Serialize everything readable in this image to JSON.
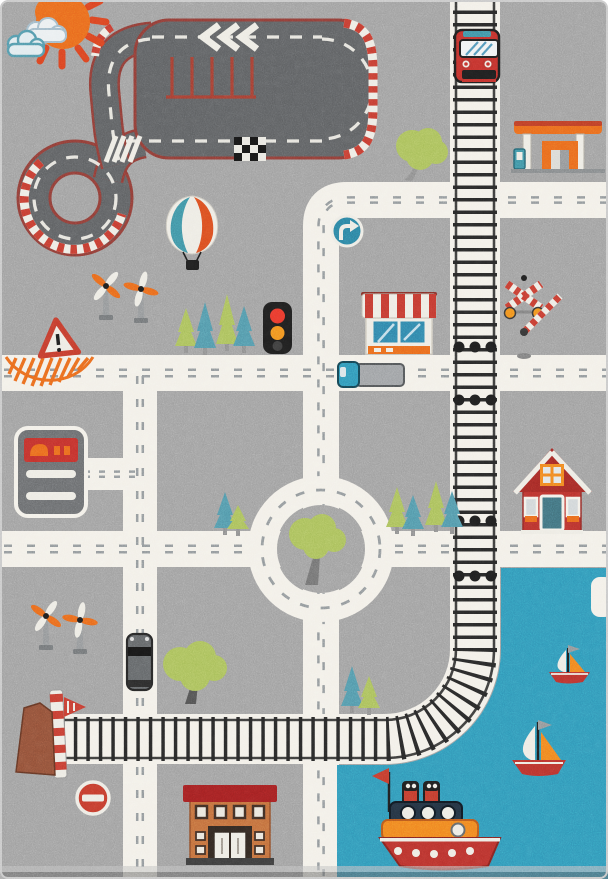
{
  "title": "Children's play rug photo: city road map with race track, railway, roundabout and harbor",
  "colors": {
    "rug_gray": "#9c9c9c",
    "road_white": "#f2efe7",
    "road_dash": "#8d9396",
    "track_asphalt": "#5b5d5f",
    "track_border": "#8a3a34",
    "curb_red": "#c23a2f",
    "water_teal": "#2f93b5",
    "rail_white": "#f2efe7",
    "sleeper_black": "#262626",
    "red": "#bf2f2a",
    "orange": "#e8651c",
    "teal": "#3d8ea0",
    "leaf_green": "#a6bd58",
    "pine_teal": "#4f93a6",
    "navy": "#22303e",
    "off_white": "#eceae2",
    "near_black": "#1d1d1d",
    "brick_orange": "#bf6a3a",
    "roof_red": "#9e1f20",
    "sign_blue": "#2a7d9d",
    "gray_mid": "#8f9294",
    "building_gray": "#67696b"
  },
  "inventory": [
    {
      "name": "sun",
      "desc": "orange sun with red rays, top left corner"
    },
    {
      "name": "clouds",
      "desc": "two blue-outlined clouds beside the sun"
    },
    {
      "name": "race-track",
      "desc": "dark asphalt race circuit with red/white kerbs, chevrons, checkered finish line and pit markings"
    },
    {
      "name": "hot-air-balloon",
      "desc": "teal/white/red balloon with black basket"
    },
    {
      "name": "railway-vertical",
      "desc": "white railway with black sleepers running from top edge"
    },
    {
      "name": "railway-curve",
      "desc": "railway curving right-to-left above the harbor"
    },
    {
      "name": "railway-horizontal",
      "desc": "railway running left toward a striped buffer stop"
    },
    {
      "name": "train",
      "desc": "red front-view train on the upper railway"
    },
    {
      "name": "gas-station",
      "desc": "orange canopy fuel station with pump"
    },
    {
      "name": "turn-right-sign",
      "desc": "blue round mandatory turn sign at road corner"
    },
    {
      "name": "warning-triangle-sign",
      "desc": "red warning triangle with exclamation mark"
    },
    {
      "name": "bus-stop-hatching",
      "desc": "orange hatched zone on the left road"
    },
    {
      "name": "traffic-light",
      "desc": "black signal with red and amber lamps"
    },
    {
      "name": "crossing-signal-windmills",
      "desc": "orange/white pinwheel crossing signals, two pairs"
    },
    {
      "name": "crossbuck-barrier",
      "desc": "railroad crossbuck with lights and striped barrier arm"
    },
    {
      "name": "shop-with-awning",
      "desc": "store front with red/white striped awning"
    },
    {
      "name": "red-house",
      "desc": "red gabled cottage with orange windows"
    },
    {
      "name": "school-building",
      "desc": "brick building with dark red roof band, bottom center"
    },
    {
      "name": "car-wash-building",
      "desc": "gray rounded building with red sign, left edge"
    },
    {
      "name": "roundabout",
      "desc": "white ring road with tree island"
    },
    {
      "name": "city-roads",
      "desc": "white streets with dashed center lines"
    },
    {
      "name": "delivery-truck",
      "desc": "teal cab truck with gray trailer"
    },
    {
      "name": "van",
      "desc": "dark gray van on left vertical street"
    },
    {
      "name": "round-trees",
      "desc": "green leafy trees"
    },
    {
      "name": "pine-trees",
      "desc": "green and teal conifers"
    },
    {
      "name": "no-entry-sign",
      "desc": "red circle with white bar"
    },
    {
      "name": "railway-buffer",
      "desc": "red/white striped buffer pole with flag and brushwood pile"
    },
    {
      "name": "harbor-water",
      "desc": "teal water area, bottom right"
    },
    {
      "name": "dock",
      "desc": "small white pier on right edge"
    },
    {
      "name": "tugboat",
      "desc": "red/orange tug with navy cabin, portholes and two funnels"
    },
    {
      "name": "sailboats",
      "desc": "two sailboats with white and orange sails"
    },
    {
      "name": "crossing-dots",
      "desc": "triple black dots where railway meets streets"
    }
  ]
}
